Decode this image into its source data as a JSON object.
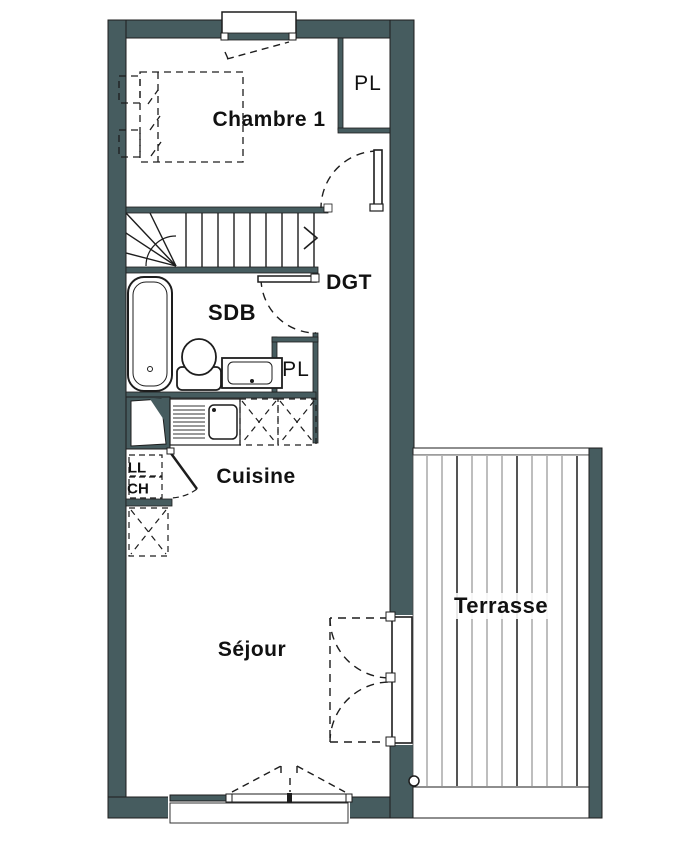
{
  "plan_title": "Apartment floor plan",
  "rooms": {
    "chambre1": "Chambre 1",
    "closet_top": "PL",
    "hallway": "DGT",
    "bathroom": "SDB",
    "closet_bath": "PL",
    "kitchen": "Cuisine",
    "washer": "LL",
    "heater": "CH",
    "living": "Séjour",
    "terrace": "Terrasse"
  },
  "colors": {
    "wall": "#465c5f",
    "line": "#1d1d1d",
    "deck_stripe": "#7d7d7d",
    "background": "#ffffff",
    "text": "#111111"
  }
}
